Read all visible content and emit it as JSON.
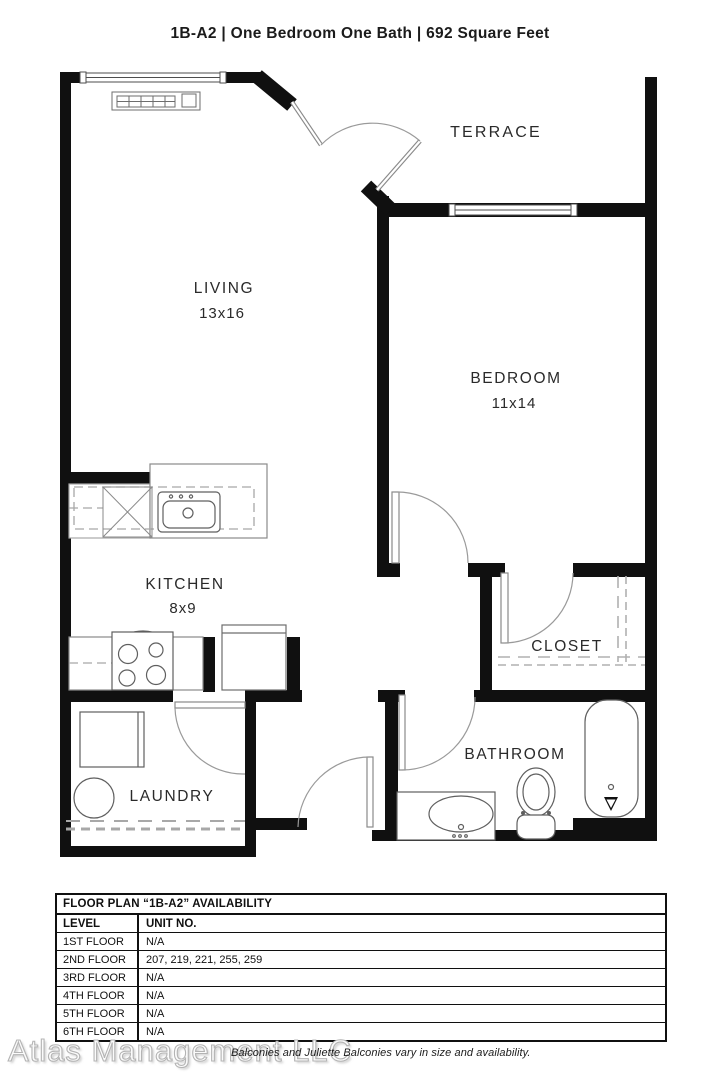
{
  "header": {
    "title": "1B-A2  |  One Bedroom One Bath  |  692 Square Feet"
  },
  "rooms": {
    "terrace": {
      "label": "TERRACE"
    },
    "living": {
      "label": "LIVING",
      "dims": "13x16"
    },
    "bedroom": {
      "label": "BEDROOM",
      "dims": "11x14"
    },
    "kitchen": {
      "label": "KITCHEN",
      "dims": "8x9"
    },
    "closet": {
      "label": "CLOSET"
    },
    "laundry": {
      "label": "LAUNDRY"
    },
    "bathroom": {
      "label": "BATHROOM"
    }
  },
  "availability": {
    "heading": "FLOOR PLAN “1B-A2” AVAILABILITY",
    "columns": {
      "level": "LEVEL",
      "units": "UNIT NO."
    },
    "rows": [
      {
        "level": "1ST FLOOR",
        "units": "N/A"
      },
      {
        "level": "2ND FLOOR",
        "units": "207, 219, 221, 255, 259"
      },
      {
        "level": "3RD FLOOR",
        "units": "N/A"
      },
      {
        "level": "4TH FLOOR",
        "units": "N/A"
      },
      {
        "level": "5TH FLOOR",
        "units": "N/A"
      },
      {
        "level": "6TH FLOOR",
        "units": "N/A"
      }
    ]
  },
  "footer": {
    "company": "Atlas Management LLC",
    "note": "Balconies and Juliette Balconies vary in size and availability."
  },
  "colors": {
    "walls": "#101010",
    "fixture_lines": "#5f5f5f",
    "dashed_lines": "#a8a8a8",
    "label_text": "#2a2a2a"
  }
}
